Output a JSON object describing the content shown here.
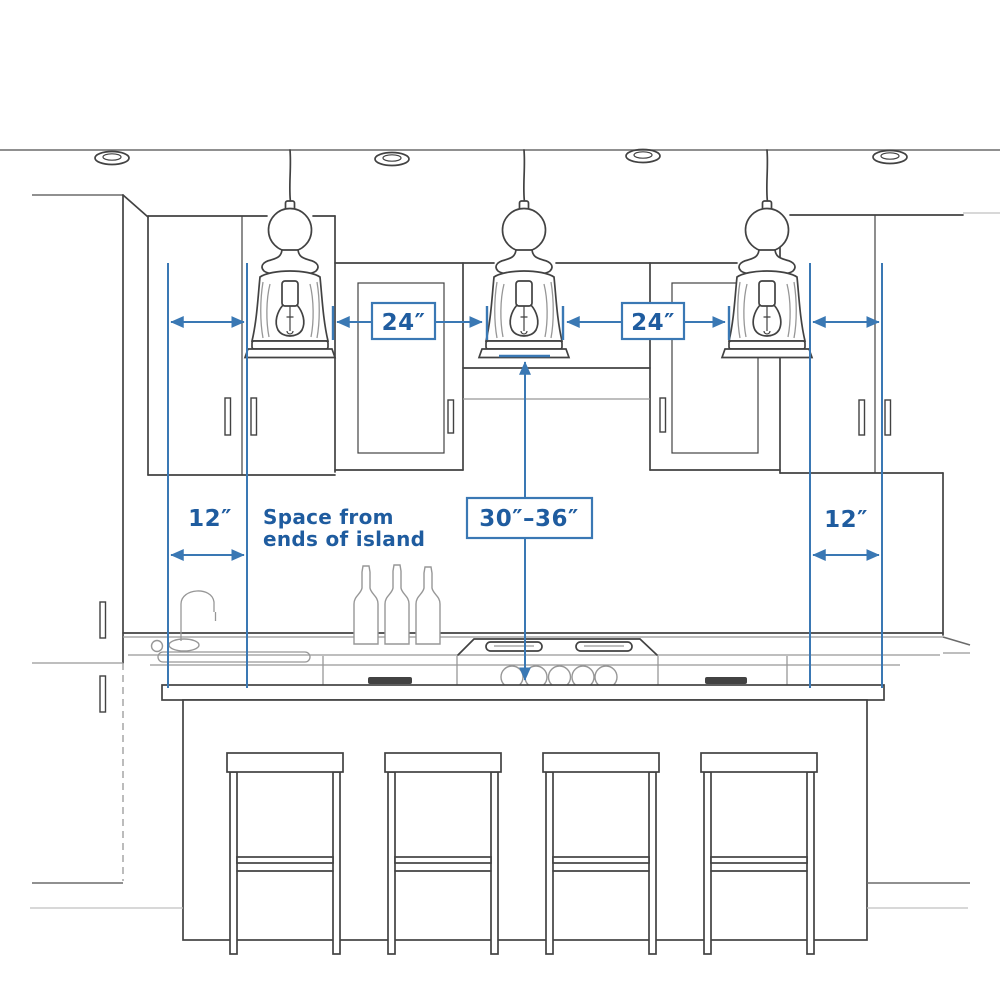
{
  "diagram": {
    "type": "kitchen-island-pendant-spacing-diagram",
    "labels": {
      "gap_left": "24″",
      "gap_right": "24″",
      "end_left": "12″",
      "end_right": "12″",
      "height_range": "30″–36″",
      "note_line1": "Space from",
      "note_line2": "ends of island"
    },
    "colors": {
      "dimension_blue": "#3a78b4",
      "label_blue": "#1f5c9f",
      "sketch_dark": "#424242",
      "sketch_light": "#979797"
    }
  }
}
